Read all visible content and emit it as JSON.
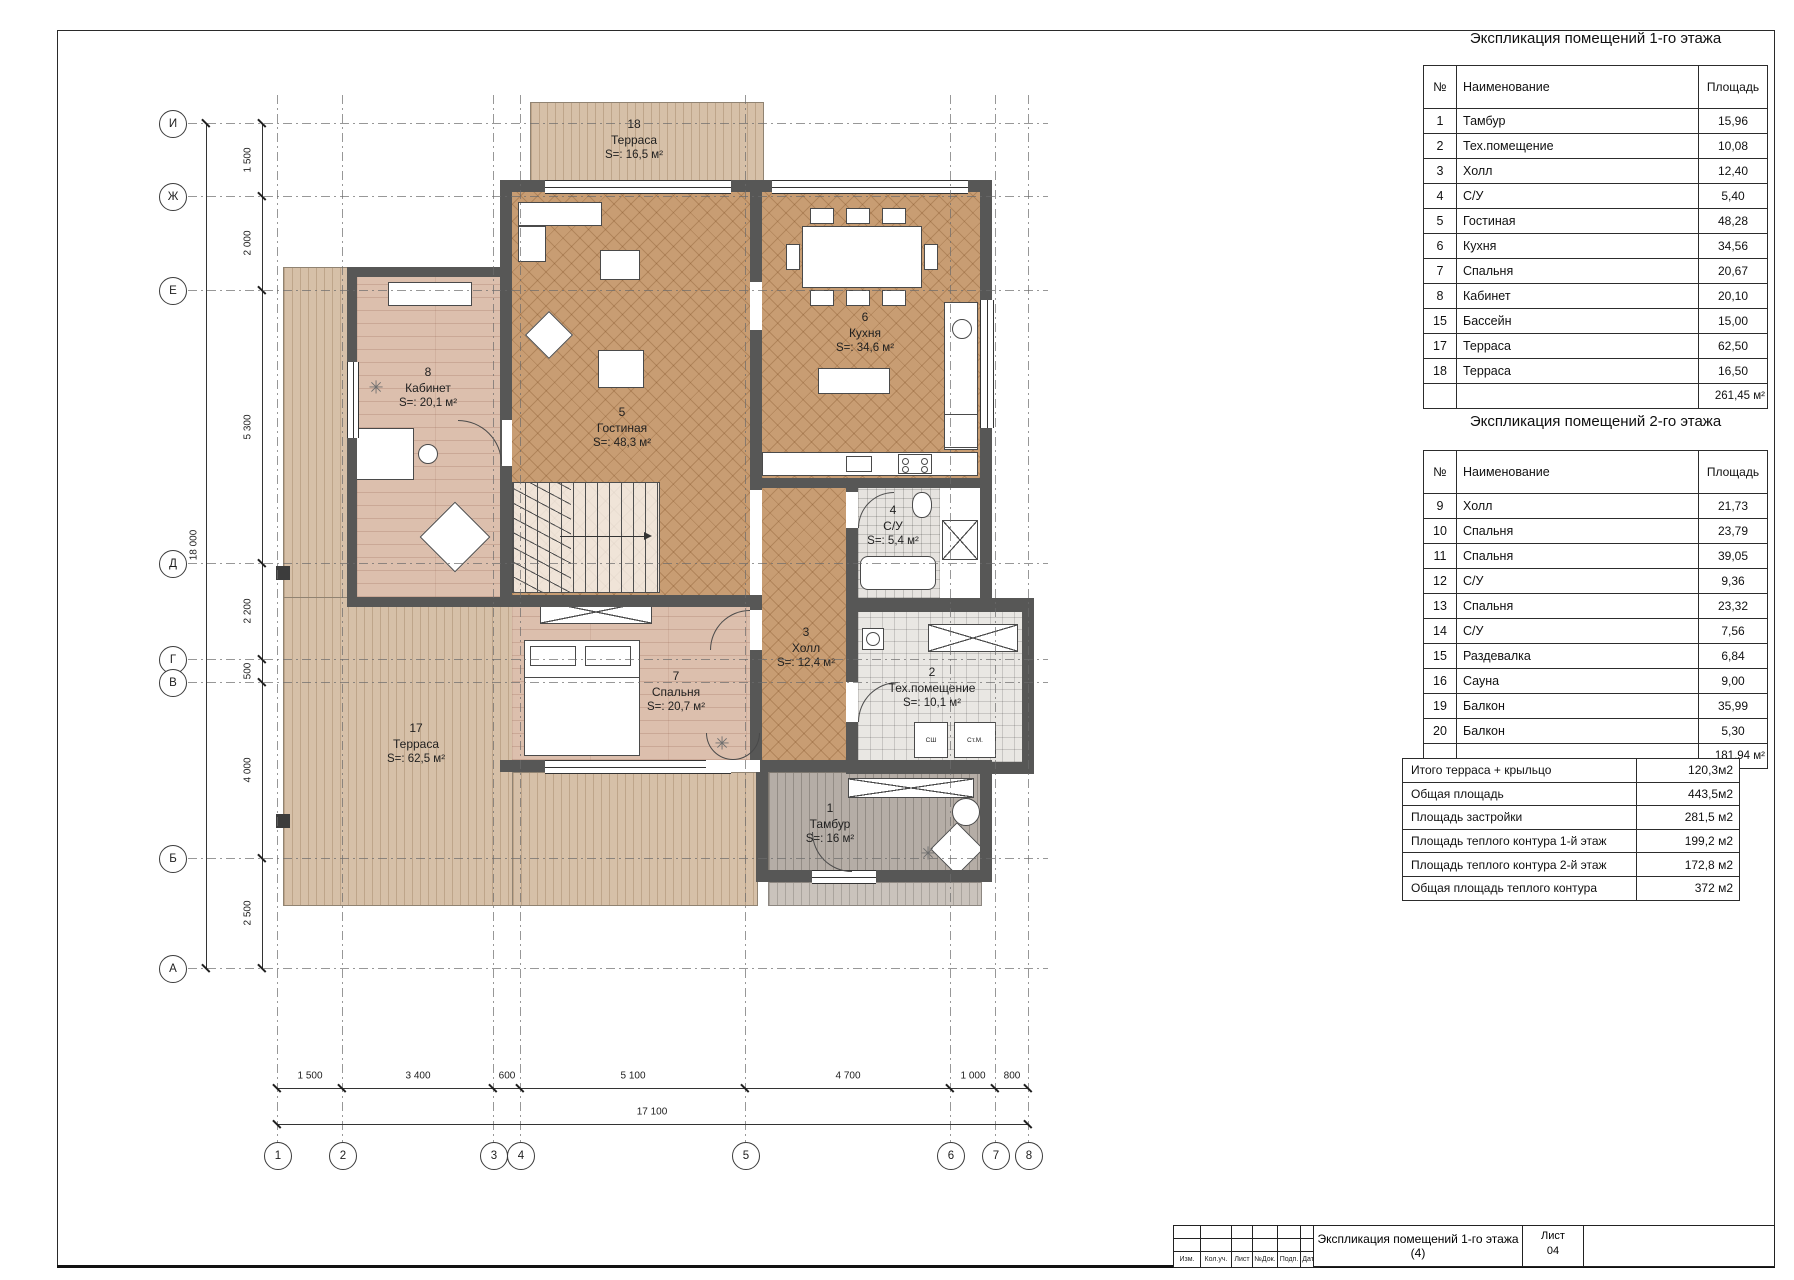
{
  "tables": {
    "meta": {
      "col_num": "№",
      "col_name": "Наименование",
      "col_area": "Площадь"
    },
    "floor1": {
      "title": "Экспликация помещений 1-го этажа",
      "rows": [
        [
          "1",
          "Тамбур",
          "15,96"
        ],
        [
          "2",
          "Тех.помещение",
          "10,08"
        ],
        [
          "3",
          "Холл",
          "12,40"
        ],
        [
          "4",
          "С/У",
          "5,40"
        ],
        [
          "5",
          "Гостиная",
          "48,28"
        ],
        [
          "6",
          "Кухня",
          "34,56"
        ],
        [
          "7",
          "Спальня",
          "20,67"
        ],
        [
          "8",
          "Кабинет",
          "20,10"
        ],
        [
          "15",
          "Бассейн",
          "15,00"
        ],
        [
          "17",
          "Терраса",
          "62,50"
        ],
        [
          "18",
          "Терраса",
          "16,50"
        ]
      ],
      "total": "261,45 м²"
    },
    "floor2": {
      "title": "Экспликация помещений 2-го этажа",
      "rows": [
        [
          "9",
          "Холл",
          "21,73"
        ],
        [
          "10",
          "Спальня",
          "23,79"
        ],
        [
          "11",
          "Спальня",
          "39,05"
        ],
        [
          "12",
          "С/У",
          "9,36"
        ],
        [
          "13",
          "Спальня",
          "23,32"
        ],
        [
          "14",
          "С/У",
          "7,56"
        ],
        [
          "15",
          "Раздевалка",
          "6,84"
        ],
        [
          "16",
          "Сауна",
          "9,00"
        ],
        [
          "19",
          "Балкон",
          "35,99"
        ],
        [
          "20",
          "Балкон",
          "5,30"
        ]
      ],
      "total": "181,94 м²"
    },
    "summary": {
      "rows": [
        [
          "Итого терраса + крыльцо",
          "120,3м2"
        ],
        [
          "Общая площадь",
          "443,5м2"
        ],
        [
          "Площадь застройки",
          "281,5 м2"
        ],
        [
          "Площадь теплого контура 1-й этаж",
          "199,2 м2"
        ],
        [
          "Площадь теплого контура 2-й этаж",
          "172,8 м2"
        ],
        [
          "Общая площадь теплого контура",
          "372 м2"
        ]
      ]
    }
  },
  "plan": {
    "rooms": {
      "r18": {
        "num": "18",
        "name": "Терраса",
        "area": "S=: 16,5 м²"
      },
      "r8": {
        "num": "8",
        "name": "Кабинет",
        "area": "S=: 20,1 м²"
      },
      "r5": {
        "num": "5",
        "name": "Гостиная",
        "area": "S=: 48,3 м²"
      },
      "r6": {
        "num": "6",
        "name": "Кухня",
        "area": "S=: 34,6 м²"
      },
      "r4": {
        "num": "4",
        "name": "С/У",
        "area": "S=: 5,4 м²"
      },
      "r3": {
        "num": "3",
        "name": "Холл",
        "area": "S=: 12,4 м²"
      },
      "r7": {
        "num": "7",
        "name": "Спальня",
        "area": "S=: 20,7 м²"
      },
      "r2": {
        "num": "2",
        "name": "Тех.помещение",
        "area": "S=: 10,1 м²"
      },
      "r17": {
        "num": "17",
        "name": "Терраса",
        "area": "S=: 62,5 м²"
      },
      "r1": {
        "num": "1",
        "name": "Тамбур",
        "area": "S=: 16 м²"
      }
    },
    "axes": {
      "letters": [
        "И",
        "Ж",
        "Е",
        "Д",
        "Г",
        "В",
        "Б",
        "А"
      ],
      "numbers": [
        "1",
        "2",
        "3",
        "4",
        "5",
        "6",
        "7",
        "8"
      ]
    },
    "dims": {
      "vertical": [
        "1 500",
        "2 000",
        "5 300",
        "2 200",
        "500",
        "4 000",
        "2 500"
      ],
      "vertical_total": "18 000",
      "horizontal": [
        "1 500",
        "3 400",
        "600",
        "5 100",
        "4 700",
        "1 000",
        "800"
      ],
      "horizontal_total": "17 100"
    },
    "labels": {
      "washer_small": "СШ",
      "washer_big": "Ст.М."
    }
  },
  "titleblock": {
    "doc_title": "Экспликация помещений 1-го этажа (4)",
    "sheet_label": "Лист",
    "sheet_number": "04",
    "stamp_cols": [
      "Изм.",
      "Кол.уч.",
      "Лист",
      "№Док.",
      "Подп.",
      "Дата"
    ]
  }
}
